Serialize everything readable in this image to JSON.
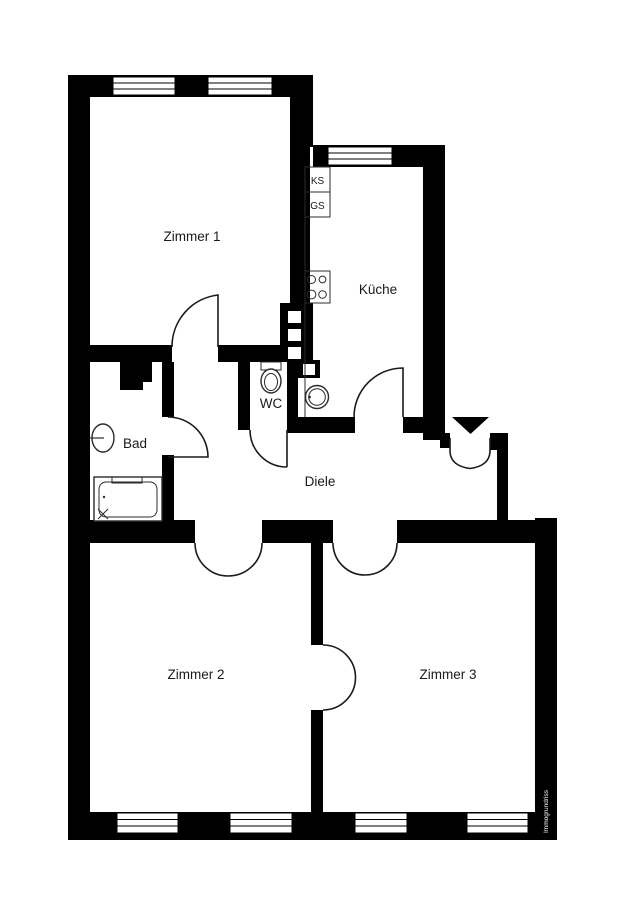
{
  "page": {
    "type": "floor-plan",
    "background": "#ffffff"
  },
  "colors": {
    "wall": "#000000",
    "floor": "#ffffff",
    "door_line": "#1a1a1a",
    "fixture_line": "#2b2b2b",
    "watermark_text": "#ffffff"
  },
  "rooms": [
    {
      "id": "zimmer1",
      "label": "Zimmer 1"
    },
    {
      "id": "kueche",
      "label": "Küche"
    },
    {
      "id": "wc",
      "label": "WC"
    },
    {
      "id": "bad",
      "label": "Bad"
    },
    {
      "id": "diele",
      "label": "Diele"
    },
    {
      "id": "zimmer2",
      "label": "Zimmer 2"
    },
    {
      "id": "zimmer3",
      "label": "Zimmer 3"
    }
  ],
  "kitchen_fixtures": [
    {
      "id": "ks",
      "label": "KS"
    },
    {
      "id": "gs",
      "label": "GS"
    }
  ],
  "watermark": {
    "text": "Immogrundriss"
  },
  "icons": {
    "entrance_arrow": "filled-triangle-down",
    "stove": "four-burner-circles",
    "kitchen_sink": "double-circle",
    "bath_sink": "oval-basin",
    "toilet": "cistern-and-bowl",
    "bathtub": "rect-with-drain-cross",
    "vent_shaft": "black-block-white-squares"
  }
}
